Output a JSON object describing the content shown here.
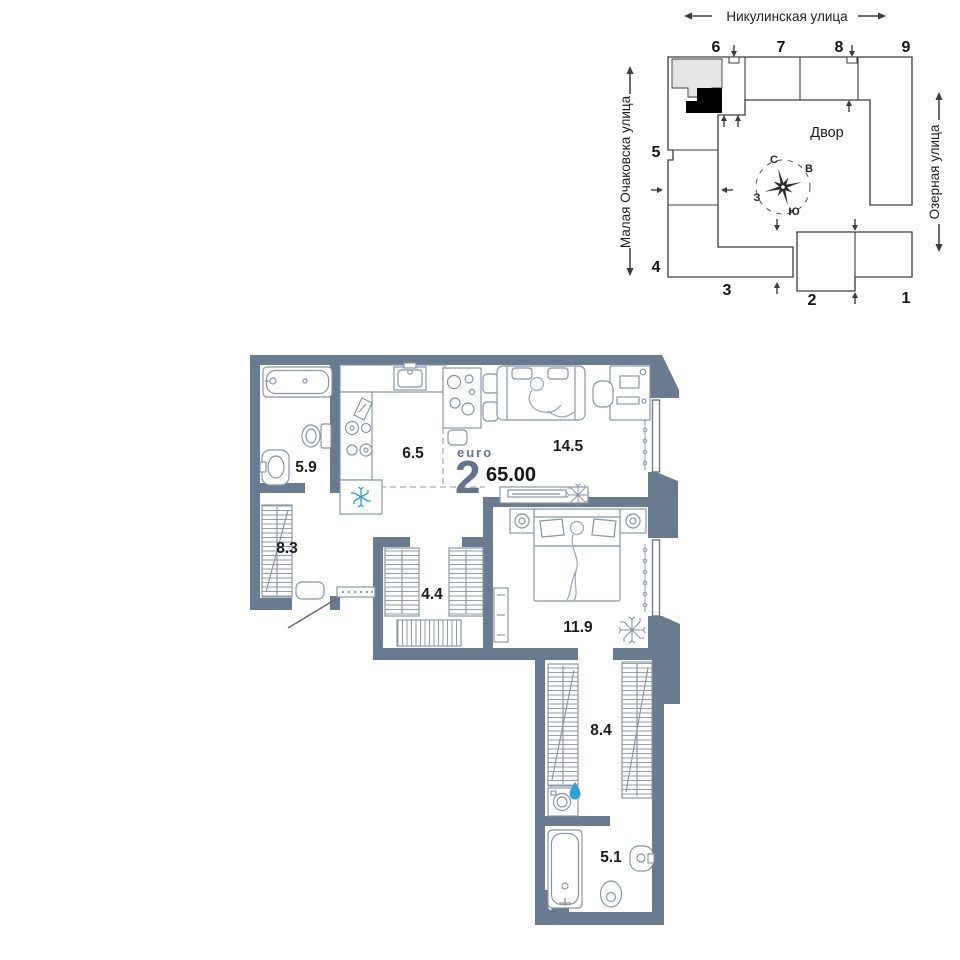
{
  "site_plan": {
    "streets": {
      "top": "Никулинская улица",
      "left": "Малая Очаковска улица",
      "right": "Озерная улица"
    },
    "courtyard_label": "Двор",
    "compass": {
      "north": "С",
      "east": "В",
      "south": "Ю",
      "west": "З"
    },
    "sections": [
      "1",
      "2",
      "3",
      "4",
      "5",
      "6",
      "7",
      "8",
      "9"
    ]
  },
  "floor_plan": {
    "unit": {
      "type_label": "euro",
      "rooms_count": "2",
      "total_area": "65.00"
    },
    "rooms": [
      {
        "area": "5.9"
      },
      {
        "area": "6.5"
      },
      {
        "area": "14.5"
      },
      {
        "area": "8.3"
      },
      {
        "area": "4.4"
      },
      {
        "area": "11.9"
      },
      {
        "area": "8.4"
      },
      {
        "area": "5.1"
      }
    ]
  },
  "colors": {
    "wall": "#697b91",
    "furniture": "#8493a7",
    "accent_blue": "#2f9fd7",
    "label_slate": "#64748f",
    "text": "#1b1b1b",
    "site_outline": "#3d3d3d",
    "highlight_gray": "#e5e5e5",
    "selected_unit": "#000000"
  }
}
